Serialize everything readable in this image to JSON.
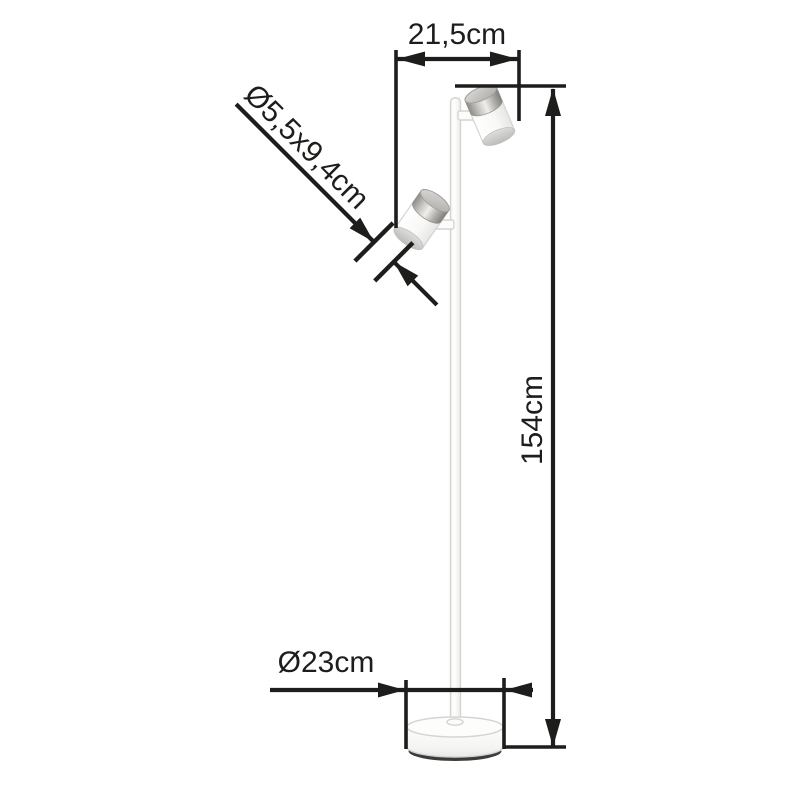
{
  "diagram": {
    "kind": "product-dimension-diagram",
    "product": {
      "type": "floor lamp with two adjustable cylindrical spotlights",
      "parts": [
        "pole",
        "round base",
        "upper spotlight head",
        "lower spotlight head"
      ]
    },
    "labels": {
      "width_top": "21,5cm",
      "head_size": "Ø5,5x9,4cm",
      "height": "154cm",
      "base_diameter": "Ø23cm"
    },
    "dimensions": [
      {
        "id": "width_top",
        "value": "21,5cm",
        "orientation": "horizontal",
        "measures": "horizontal span between lower head edge and upper head edge"
      },
      {
        "id": "head_size",
        "value": "Ø5,5x9,4cm",
        "orientation": "diagonal",
        "measures": "spotlight head diameter x length"
      },
      {
        "id": "height",
        "value": "154cm",
        "orientation": "vertical",
        "measures": "total lamp height"
      },
      {
        "id": "base_diameter",
        "value": "Ø23cm",
        "orientation": "horizontal",
        "measures": "base plate diameter"
      }
    ],
    "colors": {
      "line": "#1d1d1b",
      "lamp-white": "#fcfcfb",
      "lamp-outline": "#d4d4d2",
      "metal": "#b1afab",
      "base-shadow": "#3c3c3a"
    }
  }
}
